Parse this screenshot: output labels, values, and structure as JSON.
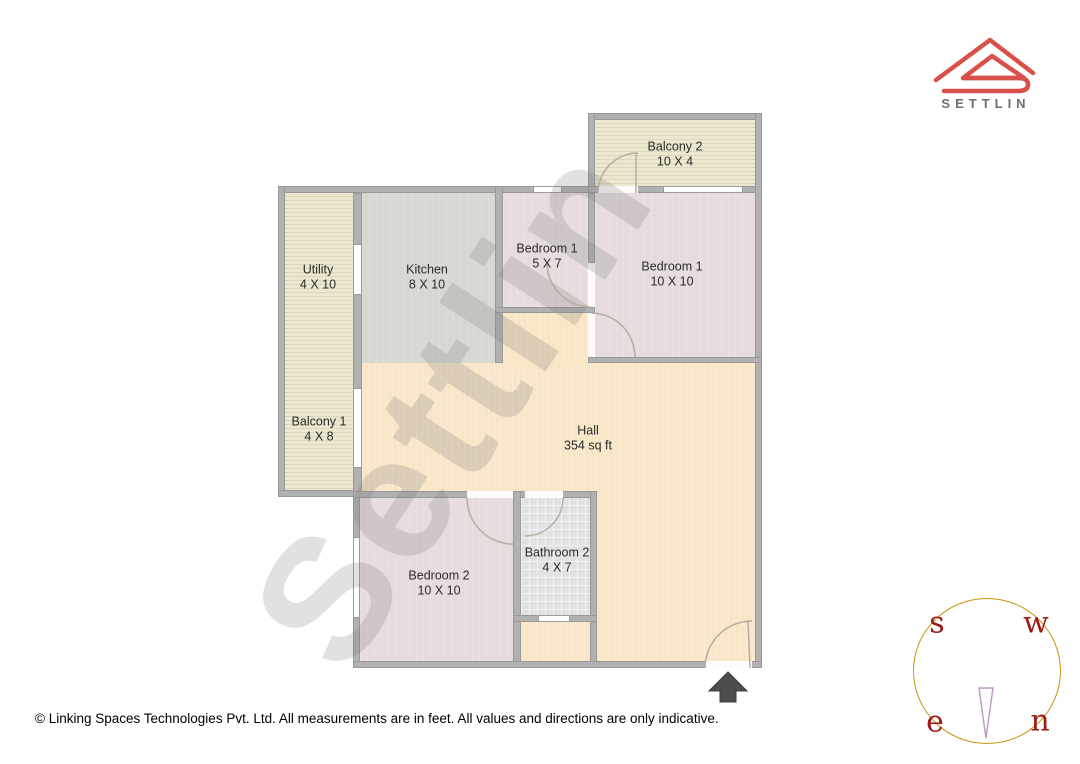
{
  "brand": {
    "logo_text": "SETTLIN"
  },
  "watermark": "Settlin",
  "rooms": [
    {
      "id": "balcony-2",
      "name": "Balcony 2",
      "dims": "10 X 4"
    },
    {
      "id": "utility",
      "name": "Utility",
      "dims": "4 X 10"
    },
    {
      "id": "kitchen",
      "name": "Kitchen",
      "dims": "8 X 10"
    },
    {
      "id": "bedroom-1-small",
      "name": "Bedroom 1",
      "dims": "5 X 7"
    },
    {
      "id": "bedroom-1",
      "name": "Bedroom 1",
      "dims": "10 X 10"
    },
    {
      "id": "balcony-1",
      "name": "Balcony 1",
      "dims": "4 X 8"
    },
    {
      "id": "hall",
      "name": "Hall",
      "dims": "354 sq ft"
    },
    {
      "id": "bedroom-2",
      "name": "Bedroom 2",
      "dims": "10 X 10"
    },
    {
      "id": "bathroom-2",
      "name": "Bathroom 2",
      "dims": "4 X 7"
    }
  ],
  "compass": {
    "s": "s",
    "w": "w",
    "e": "e",
    "n": "n"
  },
  "footer": {
    "copyright": "© Linking Spaces Technologies Pvt. Ltd. All measurements are in feet. All values and directions are only indicative."
  },
  "colors": {
    "brand_red": "#d9504b",
    "wall_gray": "#b1b1b1",
    "hall_floor": "#f8e6c6",
    "bedroom_floor": "#e6dcdd",
    "kitchen_floor": "#d5d9d2",
    "balcony_floor": "#e9e5cd",
    "bathroom_floor": "#dfe1e3",
    "compass_ring": "#c9940e",
    "compass_letters": "#9e1a15"
  }
}
